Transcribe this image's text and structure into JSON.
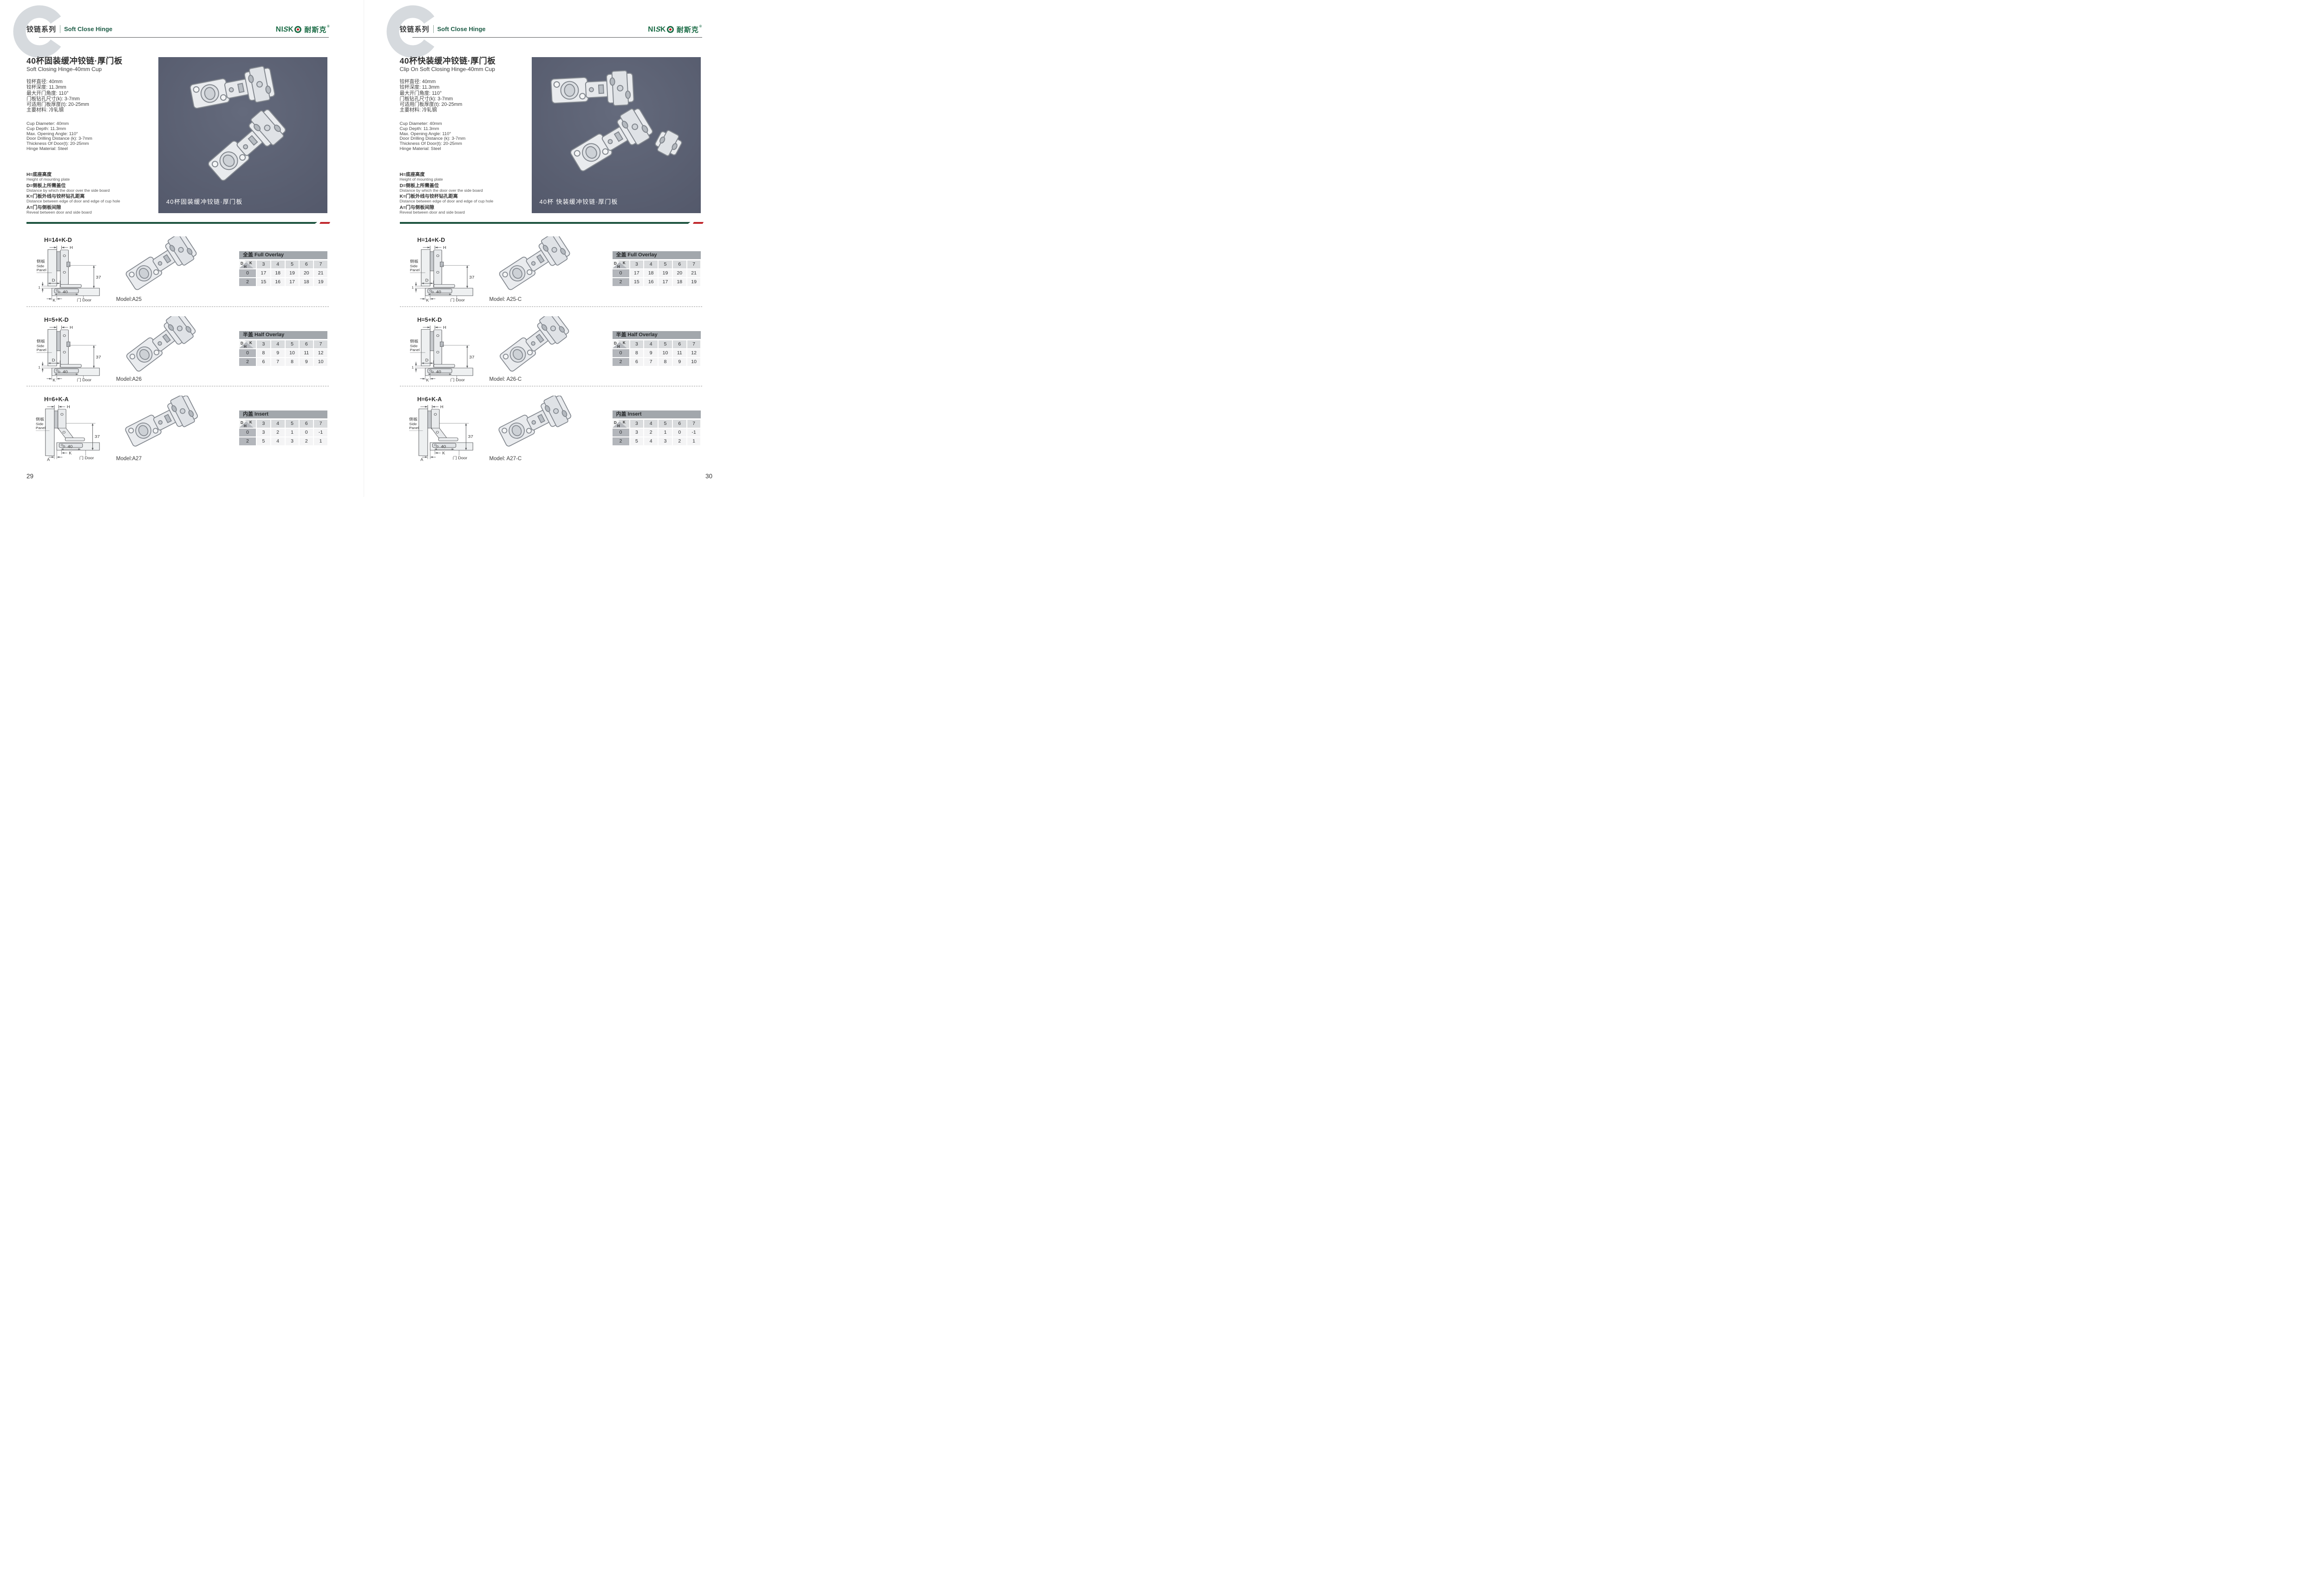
{
  "brand": {
    "part1": "NI",
    "part2": "S",
    "part3": "K",
    "cn": "耐斯克",
    "reg": "®"
  },
  "corner": {
    "d": "D",
    "k": "K",
    "h": "H"
  },
  "drawing": {
    "h": "H",
    "d": "D",
    "k": "K",
    "a": "A",
    "one": "1",
    "thirty_seven": "37",
    "forty": "40",
    "side_cn": "侧板",
    "side_en_a": "Side",
    "side_en_b": "Panel",
    "door": "门 Door"
  },
  "colors": {
    "brand_green": "#1a6b45",
    "header_green": "#1d5c46",
    "divider_green": "#1e5440",
    "accent_red": "#c0272d",
    "table_band_gray": "#a2a7ac",
    "photo_bg": "#565b6c"
  },
  "pages": [
    {
      "page_number": "29",
      "header": {
        "series_cn": "铰链系列",
        "series_en": "Soft Close Hinge"
      },
      "title_cn": "40杯固装缓冲铰链·厚门板",
      "title_en": "Soft Closing Hinge-40mm Cup",
      "specs_cn": [
        "铰杯直径: 40mm",
        "铰杯深度: 11.3mm",
        "最大开门角度: 110°",
        "门板钻孔尺寸(k): 3-7mm",
        "可适用门板厚度(t): 20-25mm",
        "主要材料: 冷轧钢"
      ],
      "specs_en": [
        "Cup Diameter: 40mm",
        "Cup Depth: 11.3mm",
        "Max. Opening Angle: 110°",
        "Door Drilling Distance (k): 3-7mm",
        "Thickness Of Door(t): 20-25mm",
        "Hinge Material: Steel"
      ],
      "legend": [
        {
          "cn": "H=底座高度",
          "en": "Height of mounting plate"
        },
        {
          "cn": "D=侧板上所需盖位",
          "en": "Distance by which the door over the side board"
        },
        {
          "cn": "K=门板外线与铰杯钻孔距离",
          "en": "Distance between edge of door and edge of cup hole"
        },
        {
          "cn": "A=门与侧板间隙",
          "en": "Reveal between door and side board"
        }
      ],
      "photo_caption": "40杯固装缓冲铰链·厚门板",
      "rows": [
        {
          "formula": "H=14+K-D",
          "model": "Model:A25",
          "table": {
            "title": "全盖 Full Overlay",
            "cols": [
              "3",
              "4",
              "5",
              "6",
              "7"
            ],
            "r1": {
              "label": "0",
              "v": [
                "17",
                "18",
                "19",
                "20",
                "21"
              ]
            },
            "r2": {
              "label": "2",
              "v": [
                "15",
                "16",
                "17",
                "18",
                "19"
              ]
            }
          }
        },
        {
          "formula": "H=5+K-D",
          "model": "Model:A26",
          "table": {
            "title": "半盖 Half Overlay",
            "cols": [
              "3",
              "4",
              "5",
              "6",
              "7"
            ],
            "r1": {
              "label": "0",
              "v": [
                "8",
                "9",
                "10",
                "11",
                "12"
              ]
            },
            "r2": {
              "label": "2",
              "v": [
                "6",
                "7",
                "8",
                "9",
                "10"
              ]
            }
          }
        },
        {
          "formula": "H=6+K-A",
          "model": "Model:A27",
          "table": {
            "title": "内盖 Insert",
            "cols": [
              "3",
              "4",
              "5",
              "6",
              "7"
            ],
            "r1": {
              "label": "0",
              "v": [
                "3",
                "2",
                "1",
                "0",
                "-1"
              ]
            },
            "r2": {
              "label": "2",
              "v": [
                "5",
                "4",
                "3",
                "2",
                "1"
              ]
            }
          }
        }
      ]
    },
    {
      "page_number": "30",
      "header": {
        "series_cn": "铰链系列",
        "series_en": "Soft Close Hinge"
      },
      "title_cn": "40杯快装缓冲铰链·厚门板",
      "title_en": "Clip On Soft Closing Hinge-40mm Cup",
      "specs_cn": [
        "铰杯直径: 40mm",
        "铰杯深度: 11.3mm",
        "最大开门角度: 110°",
        "门板钻孔尺寸(k): 3-7mm",
        "可适用门板厚度(t): 20-25mm",
        "主要材料: 冷轧钢"
      ],
      "specs_en": [
        "Cup Diameter: 40mm",
        "Cup Depth: 11.3mm",
        "Max. Opening Angle: 110°",
        "Door Drilling Distance (k): 3-7mm",
        "Thickness Of Door(t): 20-25mm",
        "Hinge Material: Steel"
      ],
      "legend": [
        {
          "cn": "H=底座高度",
          "en": "Height of mounting plate"
        },
        {
          "cn": "D=侧板上所需盖位",
          "en": "Distance by which the door over the side board"
        },
        {
          "cn": "K=门板外线与铰杯钻孔距离",
          "en": "Distance between edge of door and edge of cup hole"
        },
        {
          "cn": "A=门与侧板间隙",
          "en": "Reveal between door and side board"
        }
      ],
      "photo_caption": "40杯 快装缓冲铰链·厚门板",
      "rows": [
        {
          "formula": "H=14+K-D",
          "model": "Model: A25-C",
          "table": {
            "title": "全盖 Full Overlay",
            "cols": [
              "3",
              "4",
              "5",
              "6",
              "7"
            ],
            "r1": {
              "label": "0",
              "v": [
                "17",
                "18",
                "19",
                "20",
                "21"
              ]
            },
            "r2": {
              "label": "2",
              "v": [
                "15",
                "16",
                "17",
                "18",
                "19"
              ]
            }
          }
        },
        {
          "formula": "H=5+K-D",
          "model": "Model: A26-C",
          "table": {
            "title": "半盖 Half Overlay",
            "cols": [
              "3",
              "4",
              "5",
              "6",
              "7"
            ],
            "r1": {
              "label": "0",
              "v": [
                "8",
                "9",
                "10",
                "11",
                "12"
              ]
            },
            "r2": {
              "label": "2",
              "v": [
                "6",
                "7",
                "8",
                "9",
                "10"
              ]
            }
          }
        },
        {
          "formula": "H=6+K-A",
          "model": "Model: A27-C",
          "table": {
            "title": "内盖 Insert",
            "cols": [
              "3",
              "4",
              "5",
              "6",
              "7"
            ],
            "r1": {
              "label": "0",
              "v": [
                "3",
                "2",
                "1",
                "0",
                "-1"
              ]
            },
            "r2": {
              "label": "2",
              "v": [
                "5",
                "4",
                "3",
                "2",
                "1"
              ]
            }
          }
        }
      ]
    }
  ]
}
